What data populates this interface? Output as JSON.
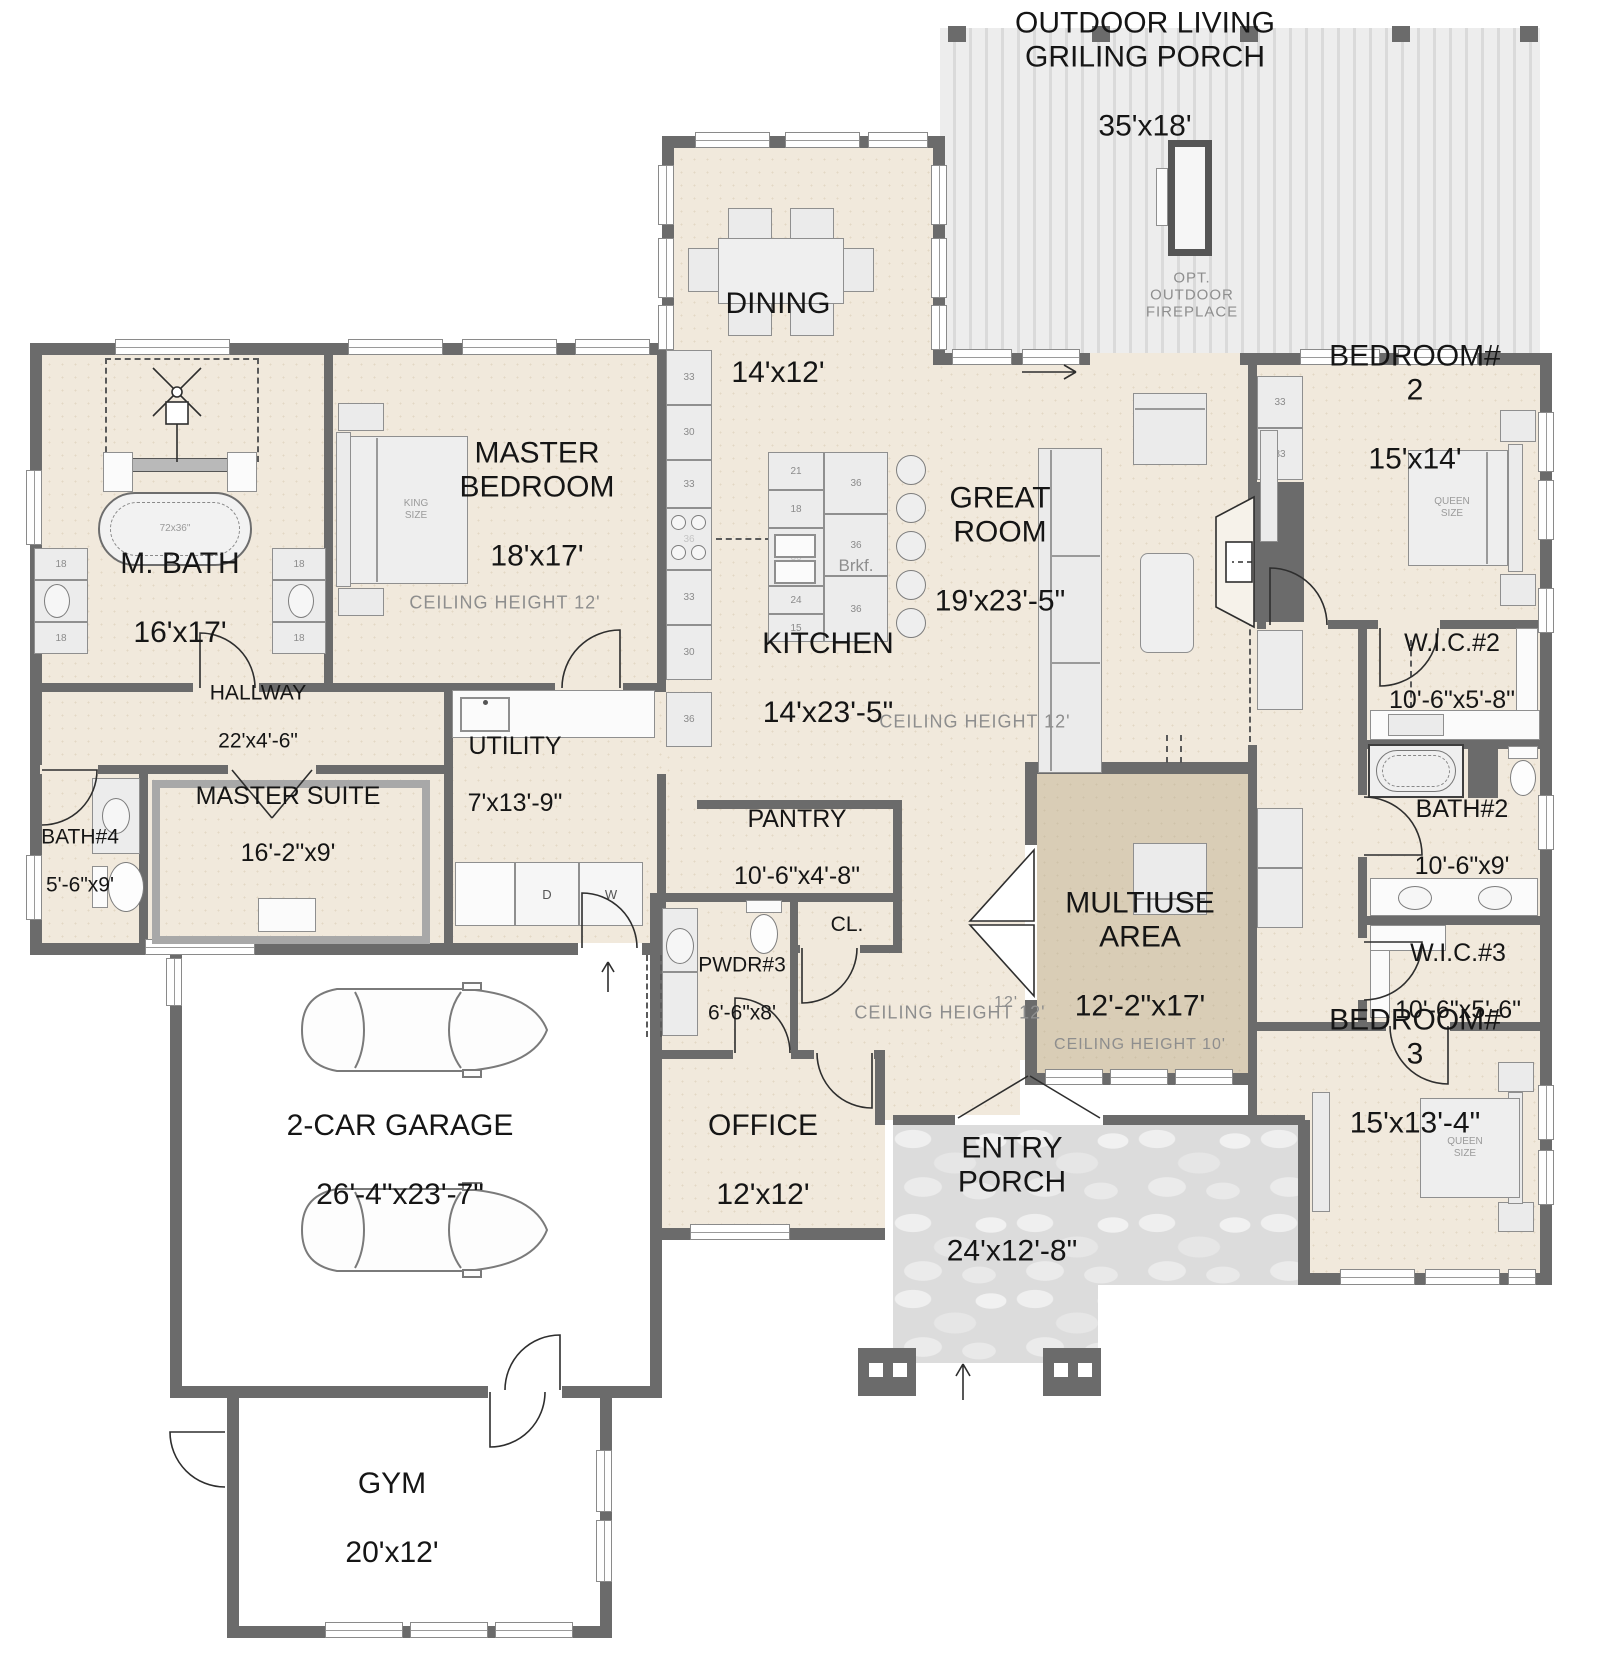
{
  "rooms": {
    "outdoor_living": {
      "name": "OUTDOOR LIVING\nGRILING PORCH",
      "dims": "35'x18'"
    },
    "dining": {
      "name": "DINING",
      "dims": "14'x12'"
    },
    "master_bedroom": {
      "name": "MASTER\nBEDROOM",
      "dims": "18'x17'"
    },
    "m_bath": {
      "name": "M. BATH",
      "dims": "16'x17'"
    },
    "hallway": {
      "name": "HALLWAY",
      "dims": "22'x4'-6\""
    },
    "bath4": {
      "name": "BATH#4",
      "dims": "5'-6\"x9'"
    },
    "master_suite": {
      "name": "MASTER SUITE",
      "dims": "16'-2\"x9'"
    },
    "utility": {
      "name": "UTILITY",
      "dims": "7'x13'-9\""
    },
    "kitchen": {
      "name": "KITCHEN",
      "dims": "14'x23'-5\""
    },
    "great_room": {
      "name": "GREAT\nROOM",
      "dims": "19'x23'-5\""
    },
    "pantry": {
      "name": "PANTRY",
      "dims": "10'-6\"x4'-8\""
    },
    "pwdr3": {
      "name": "PWDR#3",
      "dims": "6'-6\"x8'"
    },
    "cl": {
      "name": "CL."
    },
    "bedroom2": {
      "name": "BEDROOM# 2",
      "dims": "15'x14'"
    },
    "wic2": {
      "name": "W.I.C.#2",
      "dims": "10'-6\"x5'-8\""
    },
    "bath2": {
      "name": "BATH#2",
      "dims": "10'-6\"x9'"
    },
    "wic3": {
      "name": "W.I.C.#3",
      "dims": "10'-6\"x5'-6\""
    },
    "multiuse": {
      "name": "MULTIUSE\nAREA",
      "dims": "12'-2\"x17'"
    },
    "bedroom3": {
      "name": "BEDROOM# 3",
      "dims": "15'x13'-4\""
    },
    "office": {
      "name": "OFFICE",
      "dims": "12'x12'"
    },
    "entry_porch": {
      "name": "ENTRY\nPORCH",
      "dims": "24'x12'-8\""
    },
    "garage": {
      "name": "2-CAR GARAGE",
      "dims": "26'-4\"x23'-7\""
    },
    "gym": {
      "name": "GYM",
      "dims": "20'x12'"
    }
  },
  "labels": {
    "ceiling_12": "CEILING HEIGHT  12'",
    "ceiling_10": "CEILING HEIGHT  10'",
    "opt_fireplace": "OPT.\nOUTDOOR\nFIREPLACE",
    "brkf": "Brkf.",
    "king": "KING\nSIZE",
    "queen": "QUEEN\nSIZE",
    "tub_size": "72x36\"",
    "door_12": "12'",
    "dryer": "D",
    "washer": "W"
  },
  "cabinets": {
    "kitchen_column": [
      "33",
      "30",
      "33",
      "36",
      "33",
      "30",
      "36"
    ],
    "island_left": [
      "21",
      "18",
      "36",
      "24",
      "15"
    ],
    "island_right": [
      "36",
      "36",
      "36"
    ],
    "great_room": [
      "33",
      "33"
    ],
    "vanity": [
      "18",
      "36",
      "18"
    ]
  },
  "colors": {
    "wall": "#6b6b6b",
    "floor": "#f1e9dc",
    "multiuse_floor": "#d9cdb6",
    "deck": "#e8e8e8",
    "stone": "#dcdcdc"
  }
}
